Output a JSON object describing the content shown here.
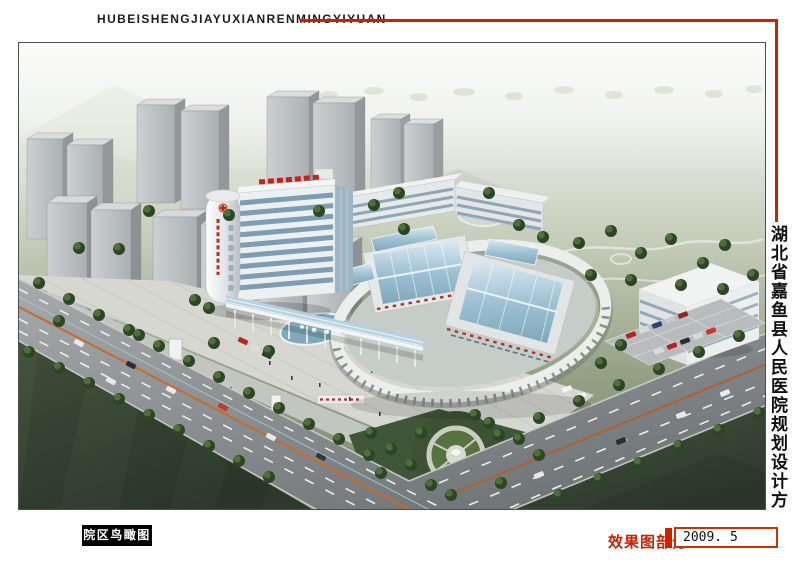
{
  "header": {
    "pinyin_title": "HUBEISHENGJIAYUXIANRENMINGYIYUAN"
  },
  "side": {
    "vertical_title": "湖北省嘉鱼县人民医院规划设计方案"
  },
  "footer": {
    "caption": "院区鸟瞰图",
    "section_label": "效果图部分",
    "date": "2009. 5"
  },
  "colors": {
    "accent_red": "#cc2200",
    "box_border_red": "#cc3300",
    "caption_bg": "#000000",
    "caption_text": "#ffffff",
    "sky_top": "#f4f6f3",
    "field_green": "#8ca17e",
    "lawn_dark": "#33432e",
    "road_gray": "#8c9092",
    "building_white": "#ebeeef",
    "glass_blue": "#88a7bd",
    "tree_green": "#2c4527"
  }
}
